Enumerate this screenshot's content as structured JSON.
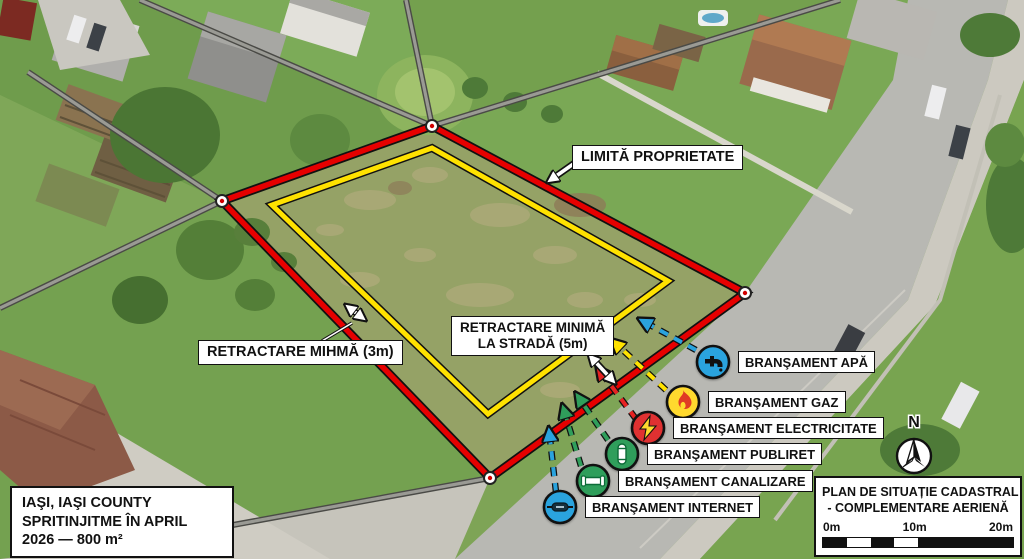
{
  "overlay": {
    "boundary_label": "LIMITĂ PROPRIETATE",
    "setback_street_line1": "RETRACTARE MINIMĂ",
    "setback_street_line2": "LA STRADĂ (5m)",
    "setback_side_label": "RETRACTARE MIHMĂ (3m)"
  },
  "utilities": [
    {
      "id": "apa",
      "label": "BRANŞAMENT APĂ",
      "color": "#2aa3de",
      "icon": "water-tap-icon"
    },
    {
      "id": "gaz",
      "label": "BRANŞAMENT GAZ",
      "color": "#ffd92e",
      "icon": "flame-icon"
    },
    {
      "id": "electricitate",
      "label": "BRANŞAMENT ELECTRICITATE",
      "color": "#e03131",
      "icon": "lightning-icon"
    },
    {
      "id": "publiret",
      "label": "BRANŞAMENT PUBLIRET",
      "color": "#2f9e5b",
      "icon": "pillar-icon"
    },
    {
      "id": "canalizare",
      "label": "BRANŞAMENT CANALIZARE",
      "color": "#2f9e5b",
      "icon": "pipe-icon"
    },
    {
      "id": "internet",
      "label": "BRANŞAMENT INTERNET",
      "color": "#2aa3de",
      "icon": "cable-icon"
    }
  ],
  "info_box": {
    "line1": "IAŞI, IAŞI COUNTY",
    "line2": "SPRITINJITME ÎN APRIL",
    "line3": "2026 — 800 m²"
  },
  "plan_box": {
    "title_line1": "PLAN DE SITUAȚIE CADASTRAL",
    "title_line2": "- COMPLEMENTARE AERIENĂ",
    "scale_labels": [
      "0m",
      "10m",
      "20m"
    ]
  },
  "compass": {
    "label": "N"
  },
  "colors": {
    "property_boundary": "#e60000",
    "setback_line": "#ffe200",
    "parcel_line": "#9a9a94",
    "road": "#b8b8b3"
  }
}
